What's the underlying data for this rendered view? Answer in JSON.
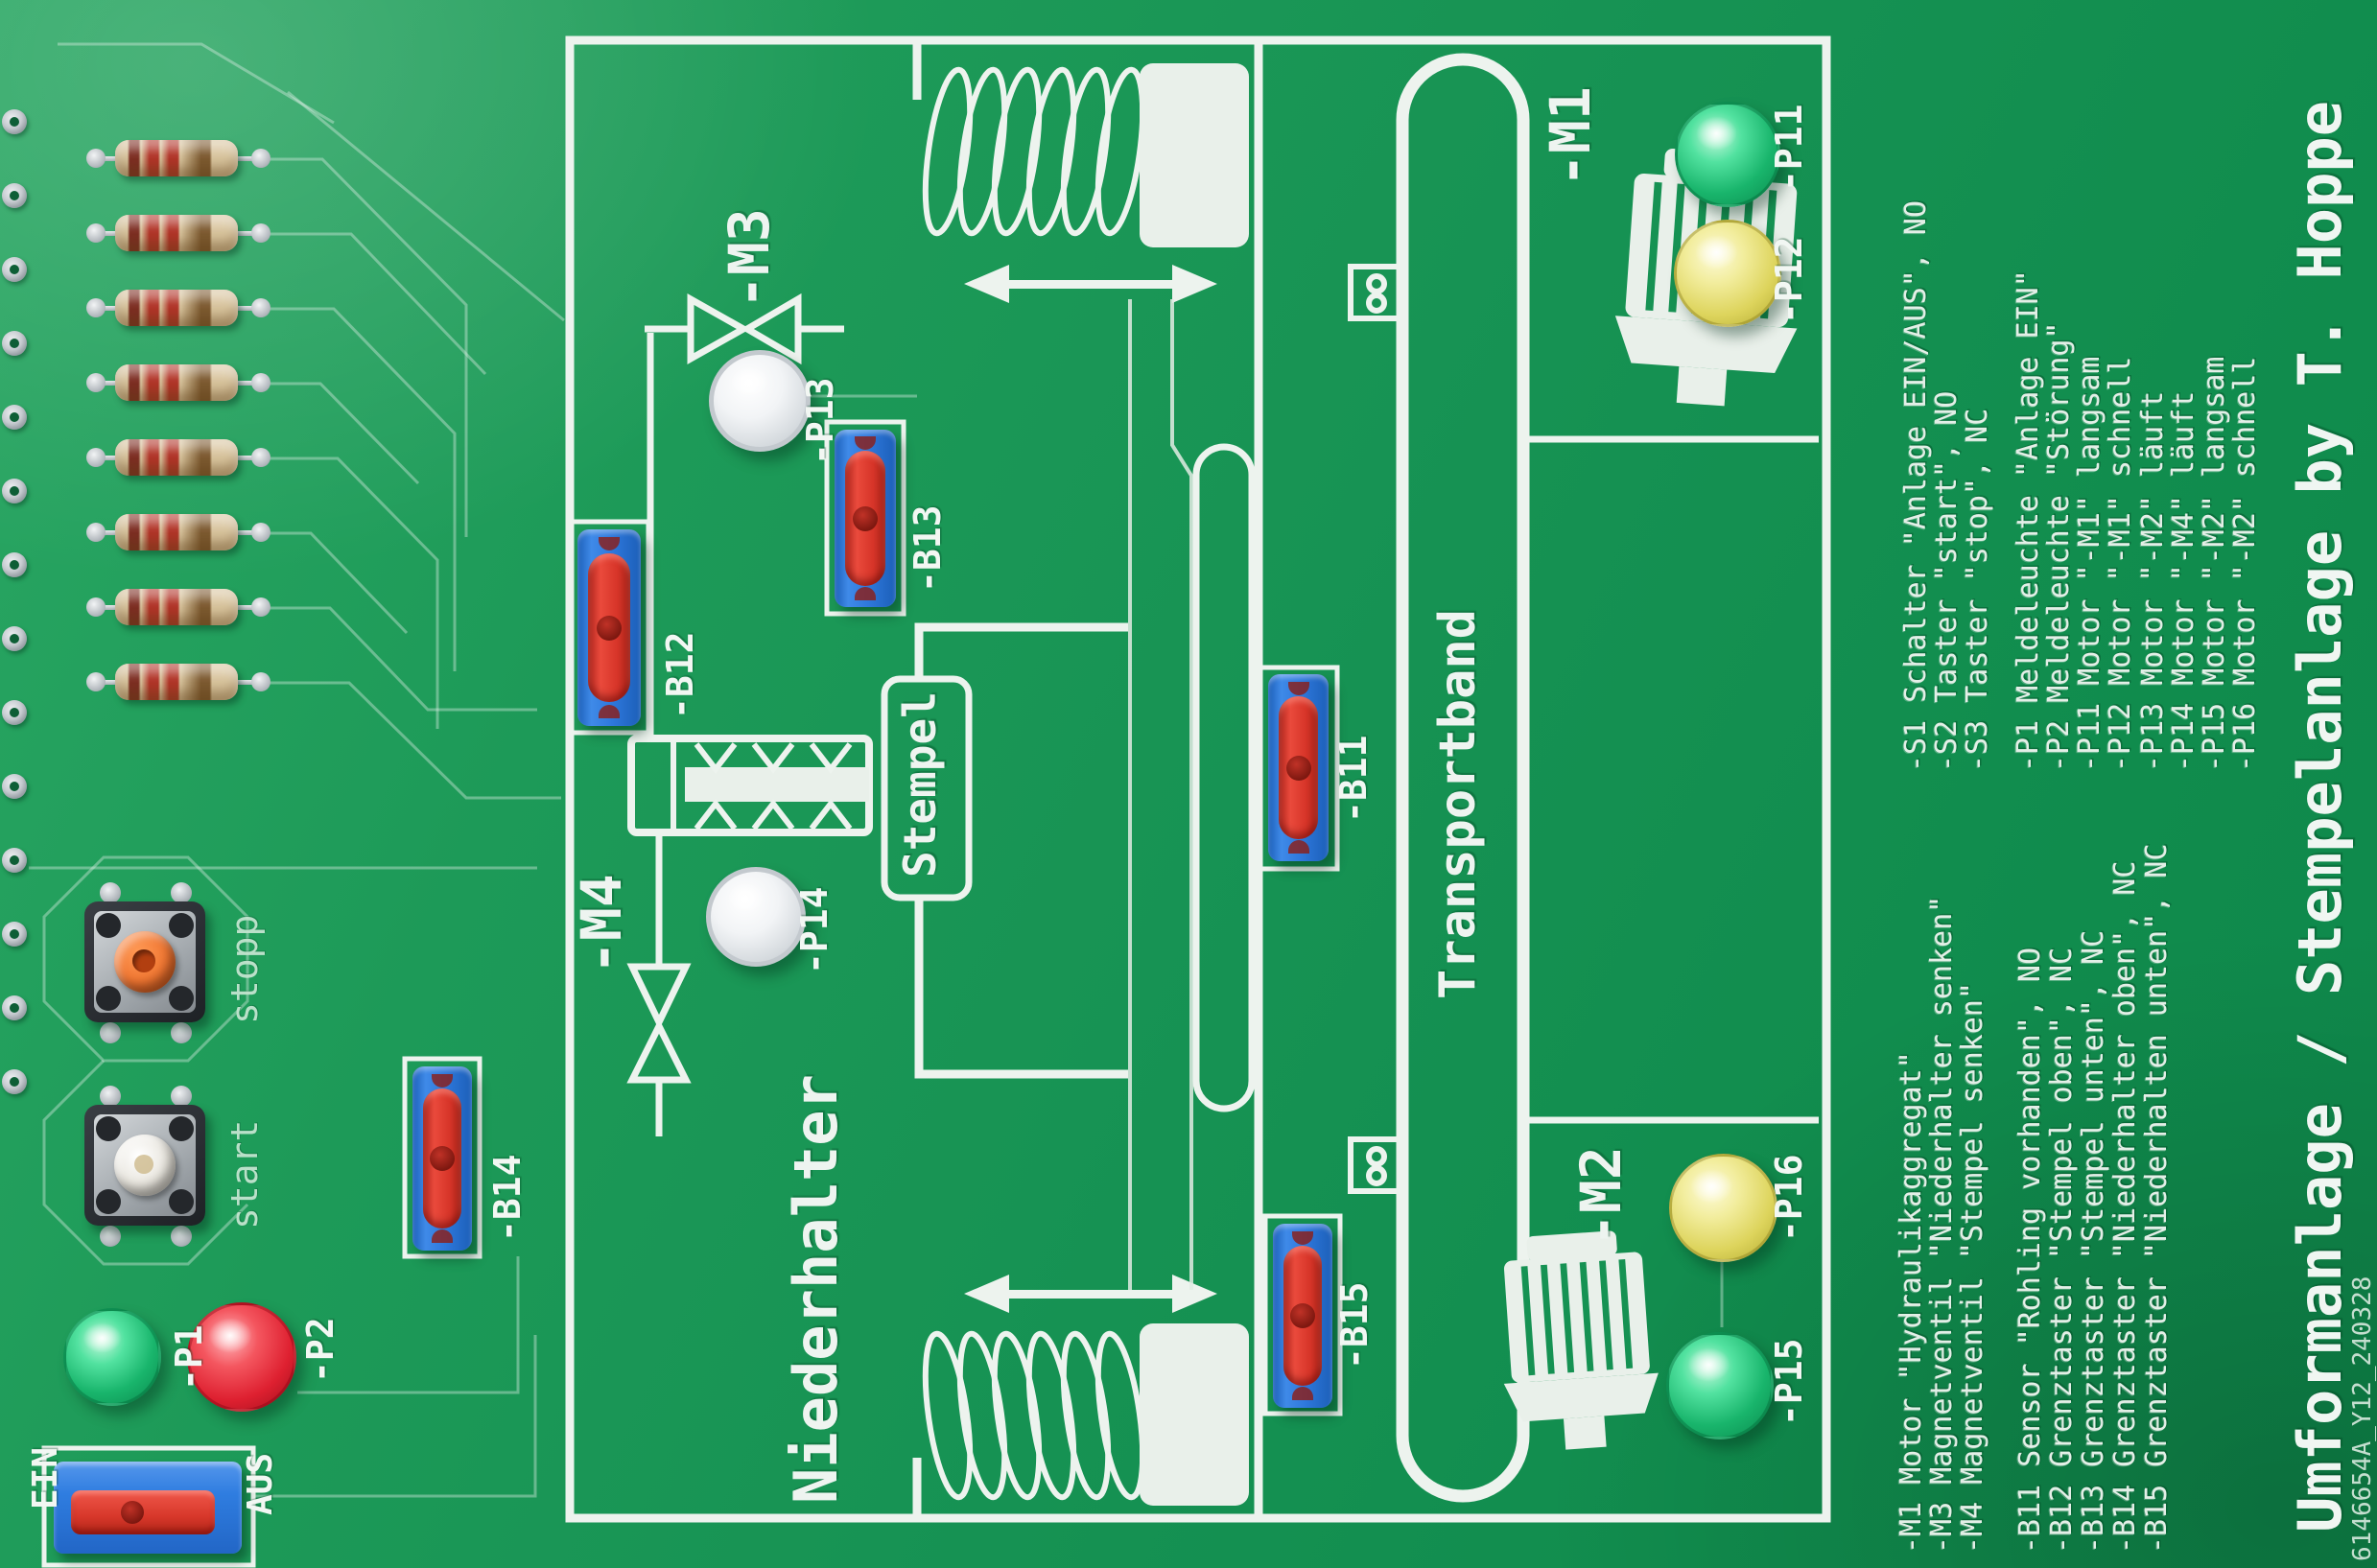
{
  "title": {
    "text": "Umformanlage / Stempelanlage by T. Hoppe",
    "serial": "6146654A_Y12_240328"
  },
  "blocks": {
    "left": "Niederhalter",
    "right": "Transportband",
    "tool": "Stempel"
  },
  "controls": {
    "stop_button": "stopp",
    "start_button": "start",
    "power_switch_on": "EIN",
    "power_switch_off": "AUS"
  },
  "labels": {
    "m1": "-M1",
    "m2": "-M2",
    "m3": "-M3",
    "m4": "-M4",
    "p1": "-P1",
    "p2": "-P2",
    "p11": "-P11",
    "p12": "-P12",
    "p13": "-P13",
    "p14": "-P14",
    "p15": "-P15",
    "p16": "-P16",
    "b11": "-B11",
    "b12": "-B12",
    "b13": "-B13",
    "b14": "-B14",
    "b15": "-B15"
  },
  "led_colors": {
    "p1": "green",
    "p2": "red",
    "p11": "green",
    "p12": "yellow",
    "p13": "white",
    "p14": "white",
    "p15": "green",
    "p16": "yellow"
  },
  "legend": {
    "switches": [
      "-S1 Schalter \"Anlage EIN/AUS\", NO",
      "-S2 Taster \"start\", NO",
      "-S3 Taster \"stop\", NC"
    ],
    "indicators": [
      "-P1 Meldeleuchte \"Anlage EIN\"",
      "-P2 Meldeleuchte \"Störung\"",
      "-P11 Motor \"-M1\" langsam",
      "-P12 Motor \"-M1\" schnell",
      "-P13 Motor \"-M2\" läuft",
      "-P14 Motor \"-M4\" läuft",
      "-P15 Motor \"-M2\" langsam",
      "-P16 Motor \"-M2\" schnell"
    ],
    "actuators": [
      "-M1 Motor \"Hydraulikaggregat\"",
      "-M3 Magnetventil \"Niederhalter senken\"",
      "-M4 Magnetventil \"Stempel senken\""
    ],
    "sensors": [
      "-B11 Sensor \"Rohling vorhanden\", NO",
      "-B12 Grenztaster \"Stempel oben\", NC",
      "-B13 Grenztaster \"Stempel unten\", NC",
      "-B14 Grenztaster \"Niederhalter oben\", NC",
      "-B15 Grenztaster \"Niederhalten unten\", NC"
    ]
  },
  "colors": {
    "board_green": "#169253",
    "silkscreen": "#edf3ee",
    "sensor_blue": "#2e78dc",
    "sensor_red": "#d63428",
    "led_green": "#19b56c",
    "led_yellow": "#ddd45c",
    "led_red": "#de2030",
    "button_orange": "#ef7430"
  }
}
